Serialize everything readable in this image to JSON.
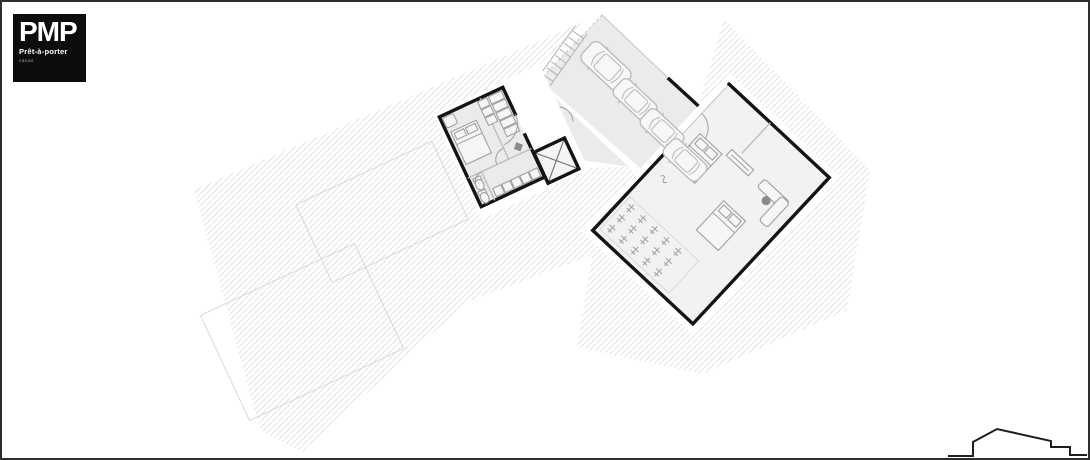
{
  "window": {
    "width": 1090,
    "height": 460,
    "background": "#ffffff"
  },
  "logo": {
    "acronym": "PMP",
    "name": "Prêt-à-porter",
    "tagline": "casas"
  },
  "plan": {
    "kind": "architectural floor plan / site plan",
    "elements": {
      "site": "hatched-terrain",
      "main_block": "bedroom-bathroom-block",
      "skylight": "crossed-atrium-box",
      "corridor": "entry-corridor",
      "carport": "carport-with-vehicles",
      "vehicles": [
        "suv",
        "sedan",
        "sedan",
        "sedan"
      ],
      "stairs": "exterior-stairs",
      "right_wing": "living-wing-with-beds-sofa-and-planted-deck",
      "garden": "planting-grid",
      "profile": "site-elevation-outline"
    }
  },
  "colors": {
    "canvas_border": "#2e2e2e",
    "logo_bg": "#0d0d0d",
    "logo_text": "#ffffff",
    "logo_tagline": "#a8a8a8",
    "wall": "#141414",
    "floor": "#ebebeb",
    "hatch": "#e3e3e3",
    "line_faint": "#d6d6d6",
    "furniture": "#a0a0a0",
    "furniture_dark": "#8a8a8a",
    "car": "#b8b8b8",
    "profile": "#1f1f1f"
  }
}
